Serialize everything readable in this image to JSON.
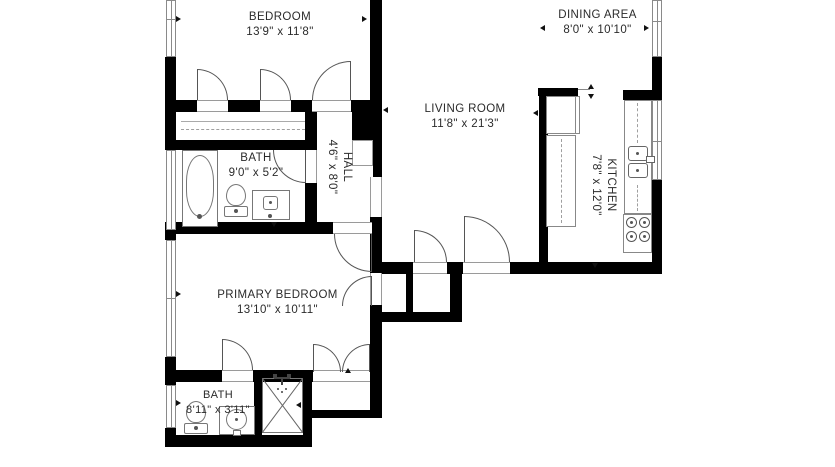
{
  "plan": {
    "colors": {
      "wall": "#000000",
      "fixture_line": "#777777",
      "window_line": "#8a8a8a",
      "text": "#2b2b2b",
      "background": "#ffffff"
    },
    "rooms": {
      "bedroom": {
        "name": "BEDROOM",
        "dims": "13'9\" x 11'8\""
      },
      "dining_area": {
        "name": "DINING AREA",
        "dims": "8'0\" x 10'10\""
      },
      "living_room": {
        "name": "LIVING ROOM",
        "dims": "11'8\" x 21'3\""
      },
      "bath": {
        "name": "BATH",
        "dims": "9'0\" x 5'2\""
      },
      "hall": {
        "name": "HALL",
        "dims": "4'6\" x 8'0\""
      },
      "kitchen": {
        "name": "KITCHEN",
        "dims": "7'8\" x 12'0\""
      },
      "primary_bedroom": {
        "name": "PRIMARY BEDROOM",
        "dims": "13'10\" x 10'11\""
      },
      "primary_bath": {
        "name": "BATH",
        "dims": "8'11\" x 3'11\""
      }
    },
    "fixtures": [
      "bathtub",
      "toilet",
      "vanity-sink",
      "shower",
      "shower-head",
      "refrigerator",
      "counter",
      "kitchen-sink",
      "stove",
      "closet-rod",
      "window",
      "door-swing"
    ]
  }
}
